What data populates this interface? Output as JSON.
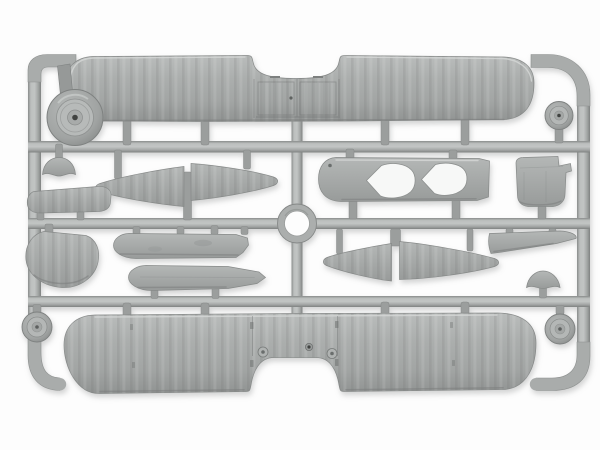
{
  "scene": {
    "description": "Photograph of a light-grey injection-moulded plastic model-kit sprue holding biplane aircraft parts on a white background",
    "background": "#fdfdfd"
  },
  "palette": {
    "plastic": "#a8abaa",
    "plastic_light": "#c3c6c5",
    "plastic_dark": "#8b8e8d",
    "plastic_deep": "#6e7170",
    "engraving": "#5f6261",
    "hub_dot": "#3f4241",
    "opening": "#f7f8f7",
    "boss": "#b0b3b2"
  },
  "parts": [
    {
      "id": "sprue-frame",
      "label": "Grey plastic sprue frame with runners and centre ring"
    },
    {
      "id": "upper-wing",
      "label": "Upper wing, full span, with centre trailing-edge cut-out and ribbed centre section"
    },
    {
      "id": "lower-wing",
      "label": "Lower wing, full span, with arched centre cut-out, locating bosses and holes"
    },
    {
      "id": "fuselage-decking",
      "label": "Fuselage top decking with two cockpit openings"
    },
    {
      "id": "engine-cowling",
      "label": "Engine cowling panel with raised lip"
    },
    {
      "id": "tailplane-half-left",
      "label": "Tailplane half, left, swept panel"
    },
    {
      "id": "tailplane-half-right",
      "label": "Tailplane half, right, swept panel"
    },
    {
      "id": "elevator-half-left",
      "label": "Elevator half, left, swept panel"
    },
    {
      "id": "elevator-half-right",
      "label": "Elevator half, right, swept panel"
    },
    {
      "id": "aileron-strip",
      "label": "Flat aileron / elevator strip"
    },
    {
      "id": "fin-panel",
      "label": "Rounded fin / fairing panel"
    },
    {
      "id": "fairing-left",
      "label": "Small dome fairing (headrest)"
    },
    {
      "id": "fairing-right",
      "label": "Small dome fairing (headrest)"
    },
    {
      "id": "decking-strip-upper",
      "label": "Fuselage side strip with oval details"
    },
    {
      "id": "decking-strip-lower",
      "label": "Fuselage side strip, tapered"
    },
    {
      "id": "wing-root-blade",
      "label": "Tapered wing-root strip"
    },
    {
      "id": "access-panel",
      "label": "Small rectangular access panel"
    },
    {
      "id": "wheel-large",
      "label": "Large spoked-hub wheel"
    },
    {
      "id": "wheel-small-tr",
      "label": "Small wheel, top right"
    },
    {
      "id": "wheel-small-bl",
      "label": "Small wheel, bottom left"
    },
    {
      "id": "wheel-small-br",
      "label": "Small wheel, bottom right"
    },
    {
      "id": "locating-ring",
      "label": "Circular locating ring at runner crossing"
    }
  ]
}
